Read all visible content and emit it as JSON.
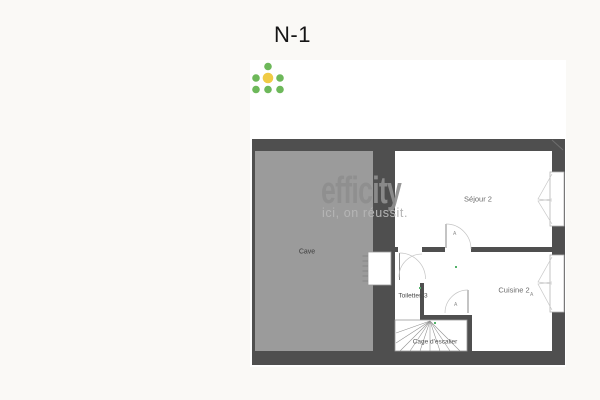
{
  "title": "N-1",
  "floorplan": {
    "rooms": {
      "cave": "Cave",
      "sejour": "Séjour 2",
      "cuisine": "Cuisine 2",
      "toilettes": "Toilettes 3",
      "escalier": "Cage d'escalier"
    },
    "door_marker": "A",
    "colors": {
      "wall": "#4f4f4f",
      "cave_fill": "#9b9b9b",
      "page_background": "#faf9f6",
      "plan_background": "#ffffff"
    }
  },
  "watermark": {
    "brand": "efficity",
    "tagline": "ici, on réussit.",
    "colors": {
      "dot_green": "#6db85a",
      "dot_yellow": "#f0cb45",
      "brand_text": "#8f8f8f",
      "tagline_text": "#b5b5b5"
    }
  }
}
